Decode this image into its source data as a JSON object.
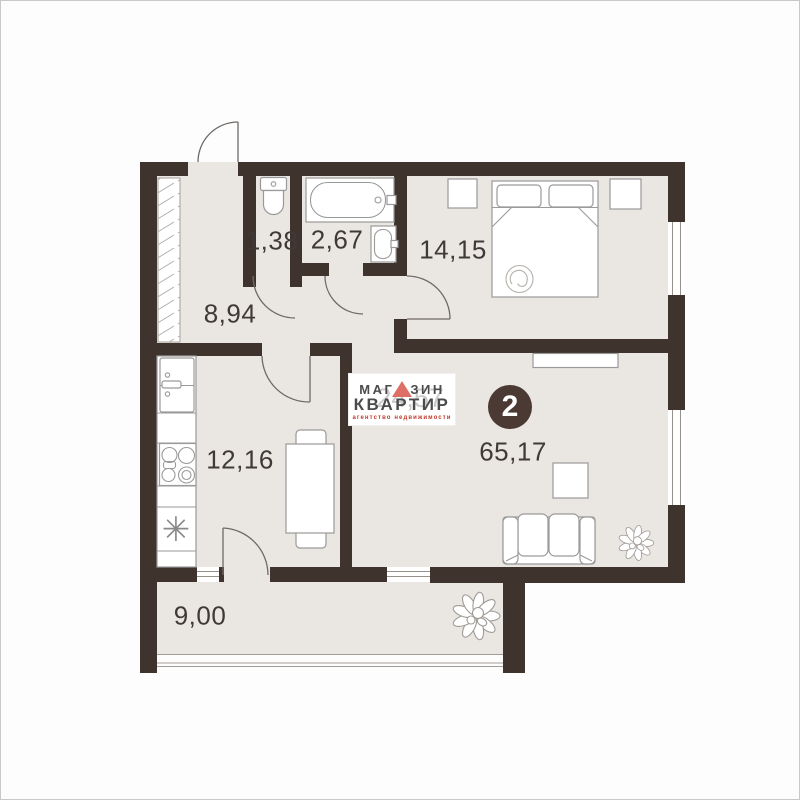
{
  "plan": {
    "kind": "apartment floor plan",
    "rooms_count": "2",
    "labels": {
      "wc": "1,38",
      "bathroom": "2,67",
      "bedroom": "14,15",
      "hallway": "8,94",
      "kitchen": "12,16",
      "total": "65,17",
      "balcony": "9,00"
    }
  },
  "logo": {
    "line1_left": "МАГ",
    "line1_right": "ЗИН",
    "line1_full": "МАГАЗИН",
    "line2": "КВАРТИР",
    "tagline": "агентство  недвижимости",
    "watermark_number": "24,57"
  },
  "icons": {
    "sink_symbol": "✳",
    "logo_triangle": "triangle-up"
  },
  "colors": {
    "wall": "#3e332d",
    "floor": "#eae6e2",
    "furniture_stroke": "#9a9a9a",
    "badge_bg": "#4a3a33",
    "logo_triangle": "#dd6f66",
    "logo_text": "#4b4b4b",
    "tagline": "#c0392b",
    "label_text": "#3f3a38"
  }
}
